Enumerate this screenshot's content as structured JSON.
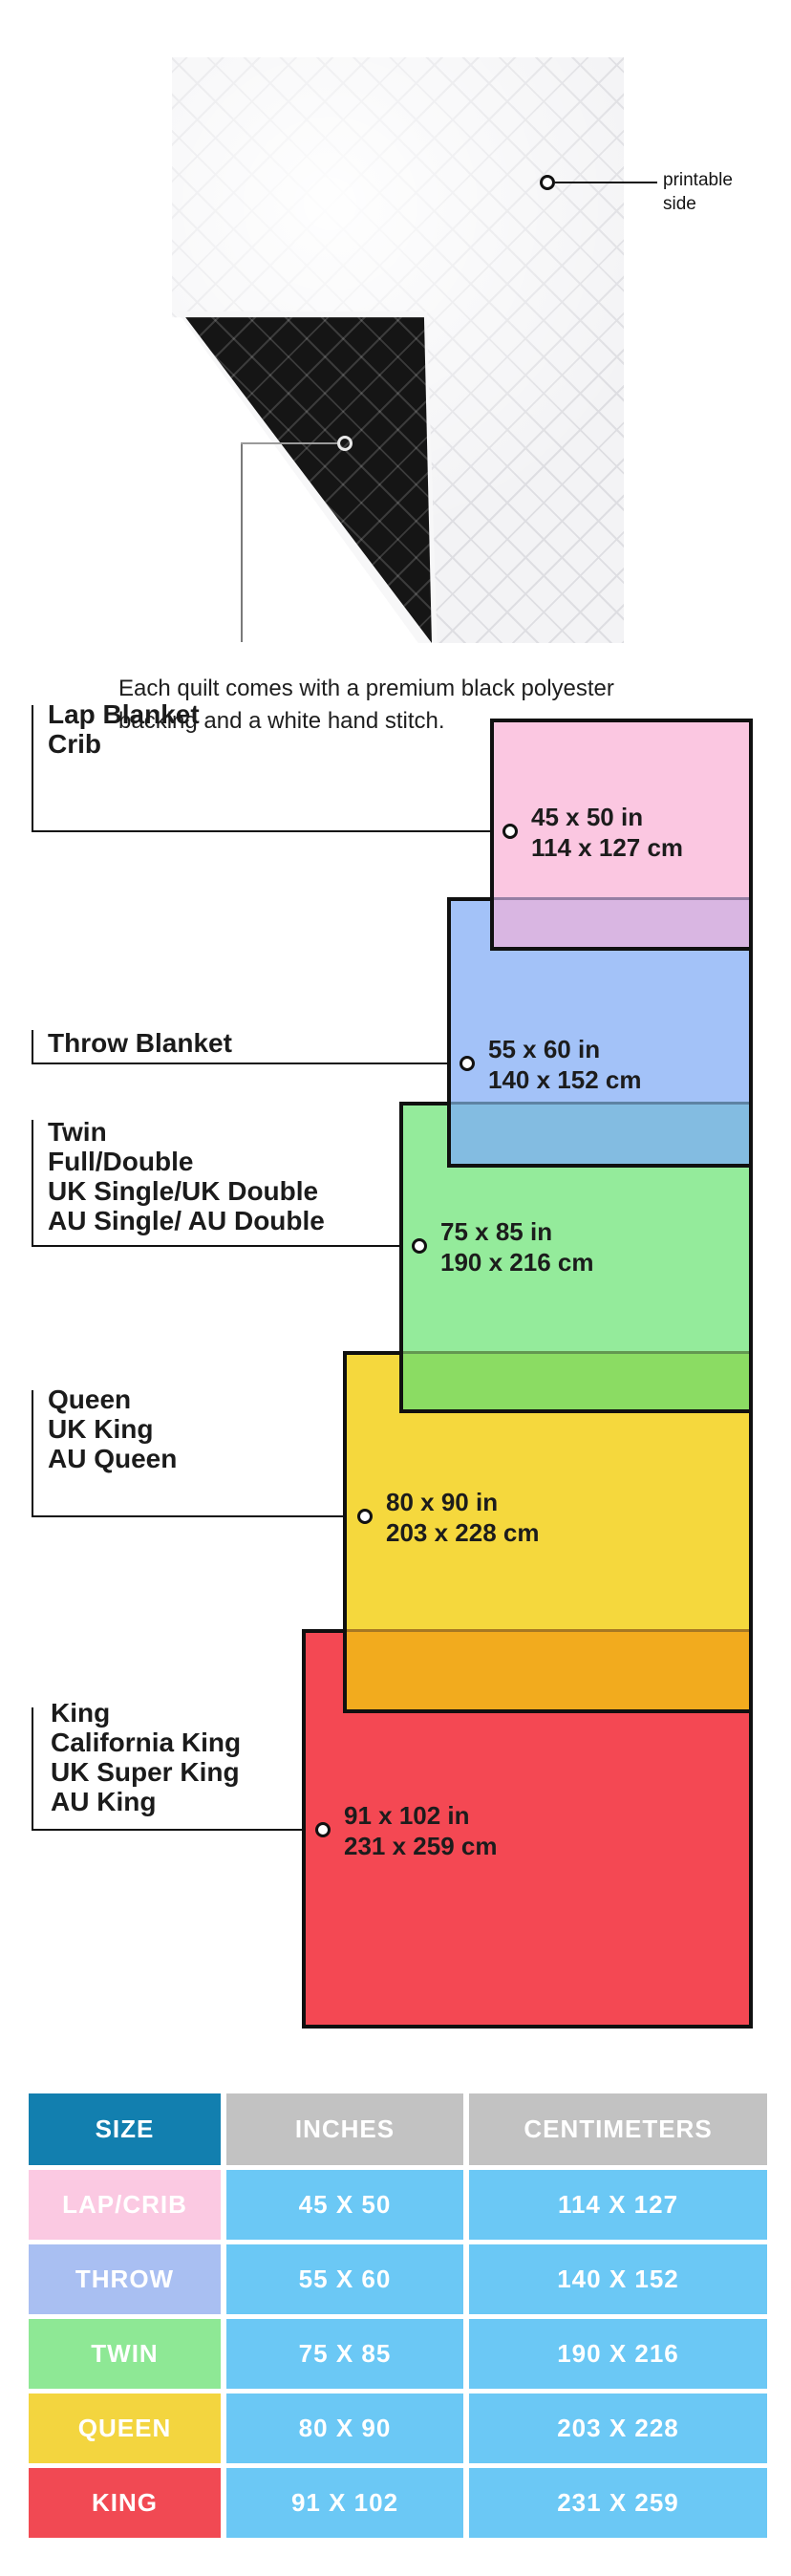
{
  "quilt": {
    "printable_label": "printable side",
    "caption": "Each quilt comes with a premium black polyester\nbacking and a white hand stitch."
  },
  "diagram": {
    "sizes": [
      {
        "id": "lap-crib",
        "group_label": "Lap Blanket\nCrib",
        "dim_in": "45 x 50 in",
        "dim_cm": "114 x 127 cm",
        "fill": "#FBC7E1",
        "overlap_fill": "#D9B6E2"
      },
      {
        "id": "throw",
        "group_label": "Throw Blanket",
        "dim_in": "55 x 60 in",
        "dim_cm": "140 x 152 cm",
        "fill": "#A3C2F8",
        "overlap_fill": "#83BCE1"
      },
      {
        "id": "twin",
        "group_label": "Twin\nFull/Double\nUK Single/UK Double\nAU Single/ AU Double",
        "dim_in": "75 x 85 in",
        "dim_cm": "190 x 216 cm",
        "fill": "#94EB9B",
        "overlap_fill": "#8BDC63"
      },
      {
        "id": "queen",
        "group_label": "Queen\nUK King\nAU Queen",
        "dim_in": "80 x 90 in",
        "dim_cm": "203 x 228 cm",
        "fill": "#F5D83D",
        "overlap_fill": "#F2AB1E"
      },
      {
        "id": "king",
        "group_label": "King\nCalifornia King\nUK Super King\nAU King",
        "dim_in": "91 x 102 in",
        "dim_cm": "231 x 259 cm",
        "fill": "#F44853",
        "overlap_fill": null
      }
    ],
    "border_color": "#101010"
  },
  "table": {
    "headers": [
      "SIZE",
      "INCHES",
      "CENTIMETERS"
    ],
    "header_size_bg": "#127FAF",
    "header_other_bg": "#C2C2C2",
    "value_cell_bg": "#6BC8F5",
    "rows": [
      {
        "label": "LAP/CRIB",
        "inches": "45 X 50",
        "cm": "114 X 127",
        "label_bg": "#FBC9E2"
      },
      {
        "label": "THROW",
        "inches": "55 X 60",
        "cm": "140 X 152",
        "label_bg": "#A9BFF2"
      },
      {
        "label": "TWIN",
        "inches": "75 X 85",
        "cm": "190 X 216",
        "label_bg": "#8EE895"
      },
      {
        "label": "QUEEN",
        "inches": "80 X 90",
        "cm": "203 X 228",
        "label_bg": "#F3D53F"
      },
      {
        "label": "KING",
        "inches": "91 X 102",
        "cm": "231 X 259",
        "label_bg": "#F14953"
      }
    ]
  }
}
